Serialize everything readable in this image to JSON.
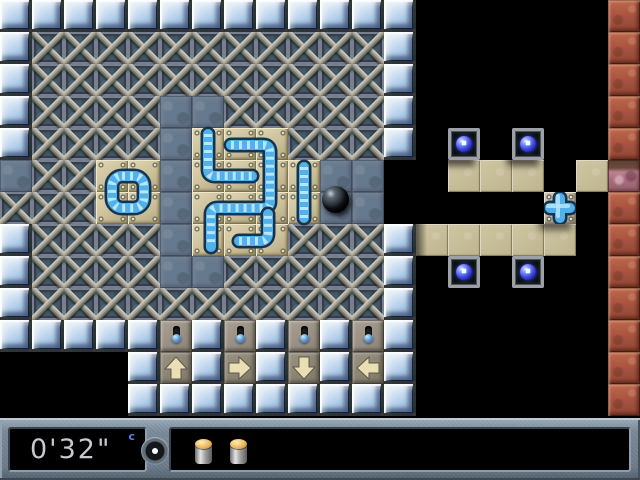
{
  "window": {
    "width": 640,
    "height": 480,
    "background": "#000000"
  },
  "board": {
    "tile_size": 32,
    "legend": {
      "I": "ice-block",
      "M": "metal-crate",
      "S": "stone-floor",
      "T": "pipe-plate",
      "t": "sand-tile",
      "R": "brick-wall",
      "P": "cracked-brick",
      "O": "orb-block",
      "C": "valve-cross-block",
      "L": "lever-switch",
      "1": "arrow-up-button",
      "2": "arrow-right-button",
      "3": "arrow-down-button",
      "4": "arrow-left-button",
      ".": "void"
    },
    "rows": [
      "IIIIIIIIIIIII......R",
      "IMMMMMMMMMMMI......R",
      "IMMMMMMMMMMMI......R",
      "IMMMMSSMMMMMI......R",
      "IMMMMSTTTMMMI.O.O..R",
      "SMMTTSTTTTSS..ttt.tP",
      "MMMTTSTTTTSS.....C.R",
      "IMMMMSTTTMMMIttttt.R",
      "IMMMMSSMMMMMI.O.O..R",
      "IMMMMMMMMMMMI......R",
      "IIIIILILILILI......R",
      "....I1I2I3I4I......R",
      "....IIIIIIIII......R"
    ],
    "arrow_directions": {
      "1": "up",
      "2": "right",
      "3": "down",
      "4": "left"
    }
  },
  "pipes": {
    "pieces": [
      {
        "name": "pipe-piece-hook",
        "d": "M208,134 L208,169 Q208,176 215,176 L252,176"
      },
      {
        "name": "pipe-piece-zigzag",
        "d": "M231,145 L263,145 Q270,145 270,152 L270,201 Q270,208 263,208 L218,208 Q211,208 211,215 L211,247"
      },
      {
        "name": "pipe-piece-corner",
        "d": "M239,241 L260,241 Q268,241 268,233 L268,214"
      },
      {
        "name": "pipe-piece-straight",
        "d": "M304,167 L304,218"
      }
    ],
    "ring": {
      "x": 112,
      "y": 176,
      "w": 32,
      "h": 32,
      "rx": 10
    },
    "cross": {
      "cx": 560,
      "cy": 208,
      "arm": 10
    }
  },
  "sprites": {
    "ball": {
      "x": 322,
      "y": 186,
      "size": 27
    }
  },
  "status_bar": {
    "timer": "0'32\"",
    "hint_key": "c",
    "items": [
      {
        "icon": "battery-icon"
      },
      {
        "icon": "battery-icon"
      }
    ]
  },
  "colors": {
    "pipe_blue": "#52b1ea",
    "orb_blue": "#3a4ee0",
    "ice": "#bcd2ea",
    "stone": "#67798e",
    "sand": "#c4bb97",
    "brick": "#a85743",
    "timer_text": "#c6c9cd",
    "hint_key_blue": "#4d82f0"
  }
}
